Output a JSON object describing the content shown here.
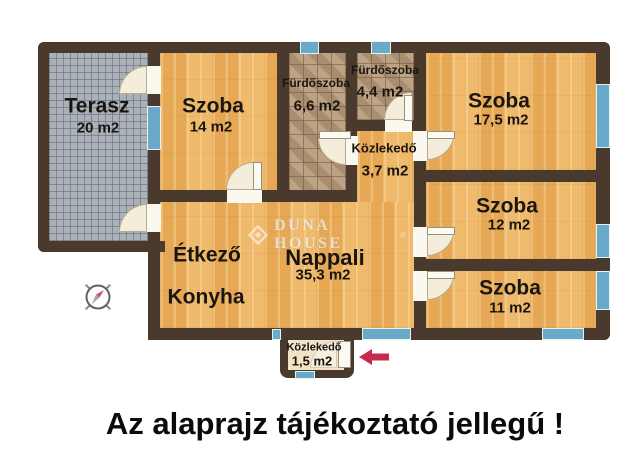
{
  "plan": {
    "caption": "Az alaprajz tájékoztató jellegű !",
    "watermark": {
      "brand": "DUNA HOUSE",
      "registered_mark": "®"
    },
    "rooms": [
      {
        "id": "terasz",
        "name": "Terasz",
        "area": "20 m2"
      },
      {
        "id": "szoba-14",
        "name": "Szoba",
        "area": "14 m2"
      },
      {
        "id": "furdoszoba-66",
        "name": "Fürdőszoba",
        "area": "6,6 m2"
      },
      {
        "id": "furdoszoba-44",
        "name": "Fürdőszoba",
        "area": "4,4 m2"
      },
      {
        "id": "szoba-175",
        "name": "Szoba",
        "area": "17,5 m2"
      },
      {
        "id": "kozlekedo-37",
        "name": "Közlekedő",
        "area": "3,7 m2"
      },
      {
        "id": "szoba-12",
        "name": "Szoba",
        "area": "12 m2"
      },
      {
        "id": "szoba-11",
        "name": "Szoba",
        "area": "11 m2"
      },
      {
        "id": "etkezo",
        "name": "Étkező",
        "area": ""
      },
      {
        "id": "konyha",
        "name": "Konyha",
        "area": ""
      },
      {
        "id": "nappali",
        "name": "Nappali",
        "area": "35,3 m2"
      },
      {
        "id": "kozlekedo-15",
        "name": "Közlekedő",
        "area": "1,5 m2"
      }
    ],
    "icons": {
      "compass": "compass-rose-icon",
      "entrance_arrow": "arrow-left-icon"
    },
    "colors": {
      "wall": "#4a3a2e",
      "wood_floor": "#ecb263",
      "bathroom_tile": "#b39878",
      "terrace_tile": "#abb1b9",
      "window": "#68aac7",
      "door": "#f4edda",
      "entrance_arrow": "#c62b4b",
      "caption_text": "#0b0b0b",
      "background": "#ffffff"
    }
  }
}
